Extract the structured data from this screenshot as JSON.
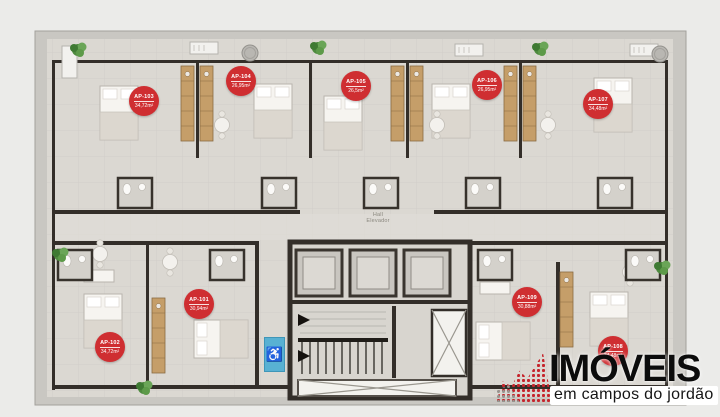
{
  "hall": {
    "line1": "Hall",
    "line2": "Elevador"
  },
  "apartments": [
    {
      "id": "AP-101",
      "area": "30,94m²"
    },
    {
      "id": "AP-102",
      "area": "34,72m²"
    },
    {
      "id": "AP-103",
      "area": "34,72m²"
    },
    {
      "id": "AP-104",
      "area": "26,95m²"
    },
    {
      "id": "AP-105",
      "area": "26,5m²"
    },
    {
      "id": "AP-106",
      "area": "26,95m²"
    },
    {
      "id": "AP-107",
      "area": "34,48m²"
    },
    {
      "id": "AP-108",
      "area": "34,48m²"
    },
    {
      "id": "AP-109",
      "area": "30,88m²"
    }
  ],
  "accessibility_symbol": "♿",
  "logo": {
    "title": "IMÓVEIS",
    "subtitle": "em campos do jordão"
  },
  "colors": {
    "badge_red": "#cf2e31",
    "accessibility_blue": "#58b1d3",
    "logo_red": "#c5242c",
    "wall_dark": "#332e29",
    "wood": "#c59e69",
    "floor": "#dbd8d2",
    "walkway": "#c9c7c2"
  }
}
